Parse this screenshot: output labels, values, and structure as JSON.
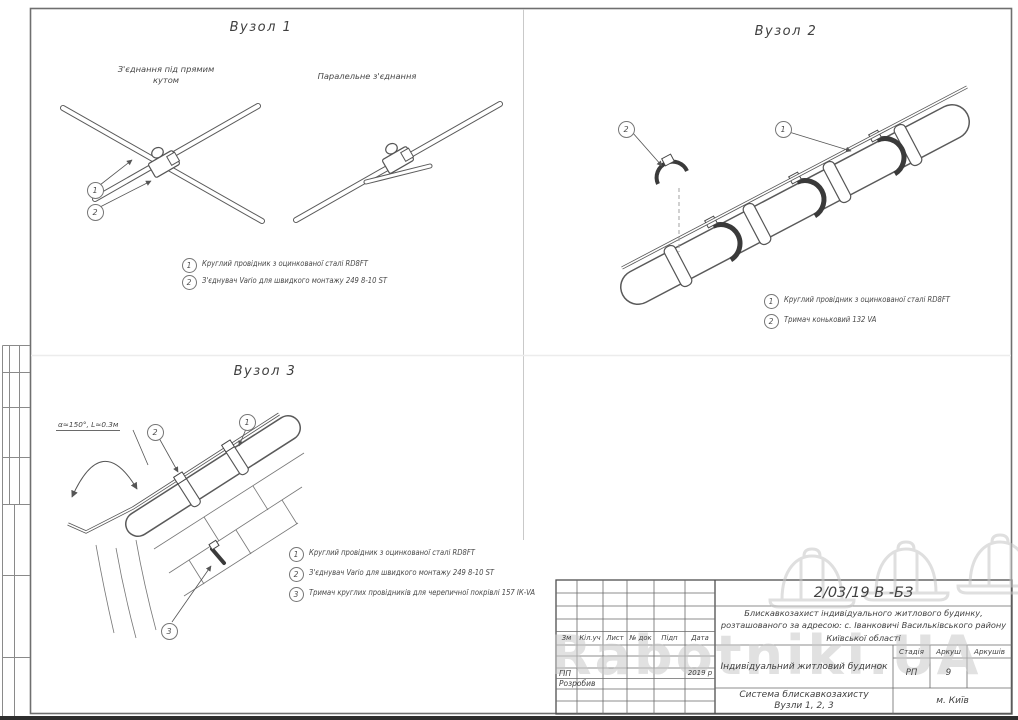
{
  "node1": {
    "title": "Вузол 1",
    "label_right_angle": "З'єднання під прямим\nкутом",
    "label_parallel": "Паралельне з'єднання",
    "callout_1": "1",
    "callout_2": "2",
    "legend": [
      {
        "num": "1",
        "text": "Круглий провідник з оцинкованої сталі  RD8FT"
      },
      {
        "num": "2",
        "text": "З'єднувач  Vario  для швидкого монтажу  249 8-10 ST"
      }
    ]
  },
  "node2": {
    "title": "Вузол 2",
    "callout_1": "1",
    "callout_2": "2",
    "legend": [
      {
        "num": "1",
        "text": "Круглий провідник з оцинкованої сталі  RD8FT"
      },
      {
        "num": "2",
        "text": "Тримач коньковий  132 VA"
      }
    ]
  },
  "node3": {
    "title": "Вузол 3",
    "bend_annotation": "α≈150°, L≈0.3м",
    "callout_1": "1",
    "callout_2": "2",
    "callout_3": "3",
    "legend": [
      {
        "num": "1",
        "text": "Круглий провідник з оцинкованої сталі  RD8FT"
      },
      {
        "num": "2",
        "text": "З'єднувач  Vario  для швидкого монтажу  249 8-10 ST"
      },
      {
        "num": "3",
        "text": "Тримач круглих провідників для черепичної покрівлі  157 ІК-VA"
      }
    ]
  },
  "title_block": {
    "doc_number": "2/03/19 В -БЗ",
    "description": "Блискавкозахист  індивідуального житлового будинку,\nрозташованого за адресою:  с. Іванковичі Васильківського району\nКиївської області",
    "table_headers": [
      "Зм",
      "Кіл.уч",
      "Лист",
      "№ док",
      "Підп",
      "Дата"
    ],
    "role_gip": "ГІП",
    "role_developer": "Розробив",
    "year": "2019 р",
    "object_name": "Індивідуальний житловий будинок",
    "sheet_title": "Система блискавкозахисту\nВузли  1, 2, 3",
    "stage_header": "Стадія",
    "sheet_header": "Аркуш",
    "sheets_total_header": "Аркушів",
    "stage": "РП",
    "sheet_number": "9",
    "sheets_total": "",
    "city": "м. Київ"
  },
  "watermark": {
    "text": "Rabotniki.UA"
  }
}
